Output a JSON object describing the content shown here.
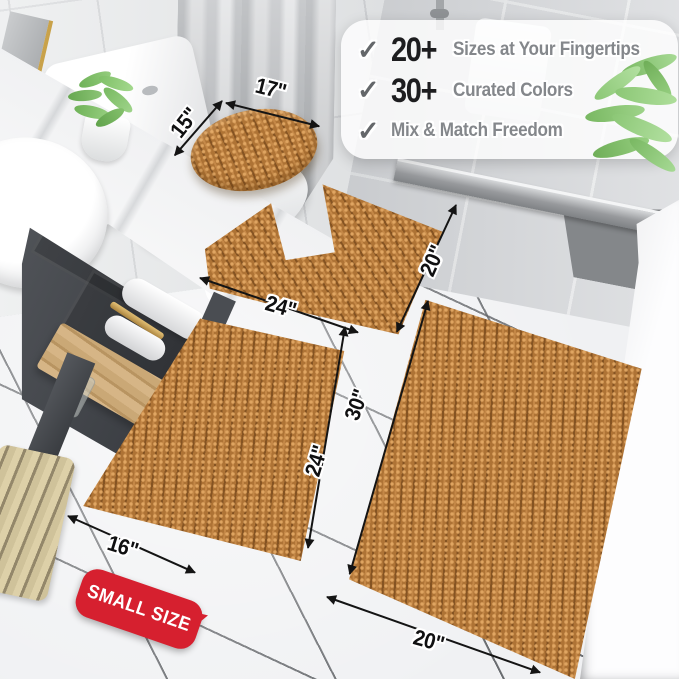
{
  "features": {
    "check_icon": "✓",
    "items": [
      {
        "stat": "20+",
        "label": "Sizes at Your Fingertips"
      },
      {
        "stat": "30+",
        "label": "Curated Colors"
      },
      {
        "stat": "",
        "label": "Mix & Match Freedom"
      }
    ]
  },
  "size_badge": {
    "label": "SMALL SIZE"
  },
  "dimensions": {
    "lid_cover_width": "17\"",
    "lid_cover_depth": "15\"",
    "contour_mat_width": "24\"",
    "contour_mat_depth": "20\"",
    "small_mat_width": "16\"",
    "small_mat_length": "24\"",
    "large_mat_length": "30\"",
    "large_mat_width": "20\""
  },
  "palette": {
    "rug_brown": "#ae7335",
    "badge_red": "#d6202f",
    "stat_text": "#1d1d1f",
    "feature_label_text": "#84878b",
    "checkmark_gray": "#64676a",
    "brass_gold": "#c9a24a"
  }
}
